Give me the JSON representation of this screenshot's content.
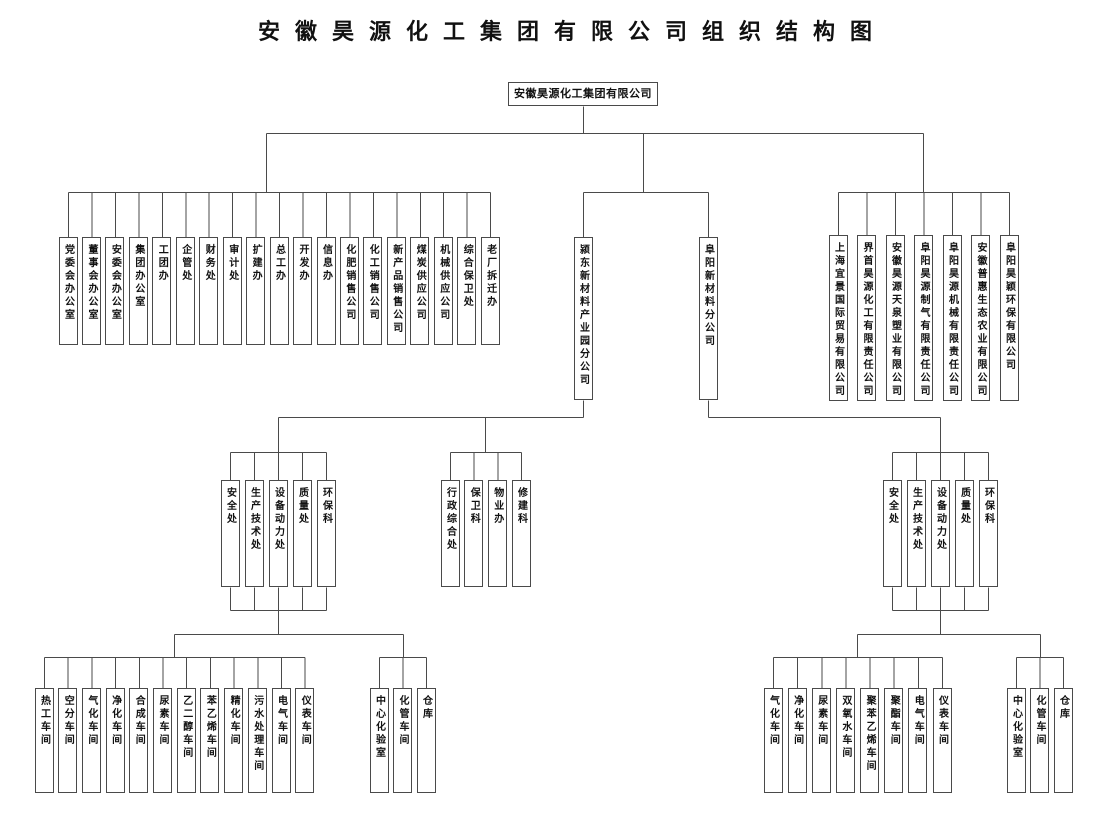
{
  "title": "安徽昊源化工集团有限公司组织结构图",
  "root": {
    "label": "安徽昊源化工集团有限公司"
  },
  "colors": {
    "line": "#4a4a4a",
    "box_border": "#4a4a4a",
    "text": "#111111",
    "background": "#ffffff"
  },
  "level1": {
    "departments": [
      "党委会办公室",
      "董事会办公室",
      "安委会办公室",
      "集团办公室",
      "工团办",
      "企管处",
      "财务处",
      "审计处",
      "扩建办",
      "总工办",
      "开发办",
      "信息办",
      "化肥销售公司",
      "化工销售公司",
      "新产品销售公司",
      "煤炭供应公司",
      "机械供应公司",
      "综合保卫处",
      "老厂拆迁办"
    ],
    "branch_companies": [
      "颍东新材料产业园分公司",
      "阜阳新材料分公司"
    ],
    "subsidiaries": [
      "上海宜景国际贸易有限公司",
      "界首昊源化工有限责任公司",
      "安徽昊源天泉塑业有限公司",
      "阜阳昊源制气有限责任公司",
      "阜阳昊源机械有限责任公司",
      "安徽普惠生态农业有限公司",
      "阜阳昊颖环保有限公司"
    ]
  },
  "yingdong": {
    "admin_departments": [
      "安全处",
      "生产技术处",
      "设备动力处",
      "质量处",
      "环保科"
    ],
    "service_departments": [
      "行政综合处",
      "保卫科",
      "物业办",
      "修建科"
    ],
    "workshops": [
      "热工车间",
      "空分车间",
      "气化车间",
      "净化车间",
      "合成车间",
      "尿素车间",
      "乙二醇车间",
      "苯乙烯车间",
      "精化车间",
      "污水处理车间",
      "电气车间",
      "仪表车间"
    ],
    "support_units": [
      "中心化验室",
      "化管车间",
      "仓库"
    ]
  },
  "fuyang": {
    "admin_departments": [
      "安全处",
      "生产技术处",
      "设备动力处",
      "质量处",
      "环保科"
    ],
    "workshops": [
      "气化车间",
      "净化车间",
      "尿素车间",
      "双氧水车间",
      "聚苯乙烯车间",
      "聚酯车间",
      "电气车间",
      "仪表车间"
    ],
    "support_units": [
      "中心化验室",
      "化管车间",
      "仓库"
    ]
  }
}
